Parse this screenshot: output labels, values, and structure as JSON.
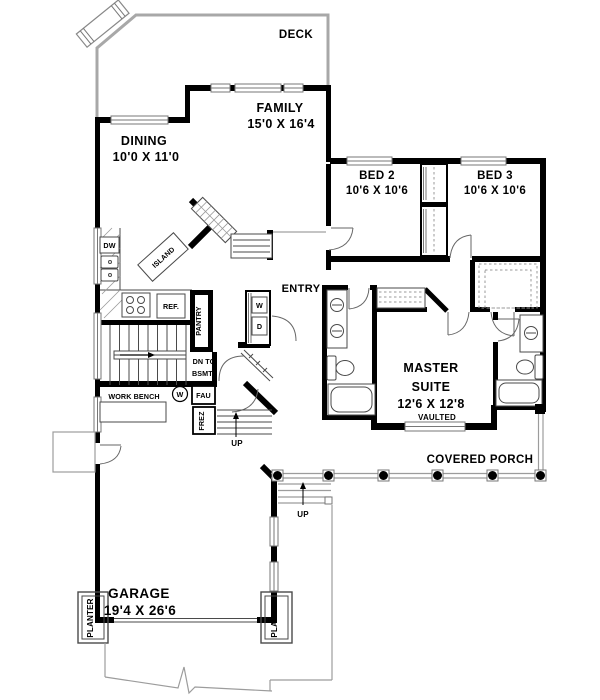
{
  "colors": {
    "wall": "#000000",
    "line": "#4a4a4a",
    "light_gray": "#a8a8a8",
    "background": "#ffffff"
  },
  "rooms": {
    "deck": {
      "label": "DECK"
    },
    "family": {
      "label": "FAMILY",
      "dims": "15'0 X 16'4"
    },
    "dining": {
      "label": "DINING",
      "dims": "10'0 X 11'0"
    },
    "bed2": {
      "label": "BED 2",
      "dims": "10'6 X 10'6"
    },
    "bed3": {
      "label": "BED 3",
      "dims": "10'6 X 10'6"
    },
    "entry": {
      "label": "ENTRY"
    },
    "master_suite": {
      "label1": "MASTER",
      "label2": "SUITE",
      "dims": "12'6 X 12'8",
      "note": "VAULTED"
    },
    "covered_porch": {
      "label": "COVERED PORCH"
    },
    "garage": {
      "label": "GARAGE",
      "dims": "19'4 X 26'6"
    }
  },
  "fixtures": {
    "dishwasher": "DW",
    "refrigerator": "REF.",
    "pantry": "PANTRY",
    "island": "ISLAND",
    "washer_box": "W",
    "dryer_box": "D",
    "washer_circle": "W",
    "fau": "FAU",
    "freezer": "FREZ",
    "work_bench": "WORK BENCH",
    "stairs_note_line1": "DN TO",
    "stairs_note_line2": "BSMT.",
    "garage_steps": "UP",
    "entry_steps": "UP",
    "planter_left": "PLANTER",
    "planter_right": "PLANTER"
  }
}
